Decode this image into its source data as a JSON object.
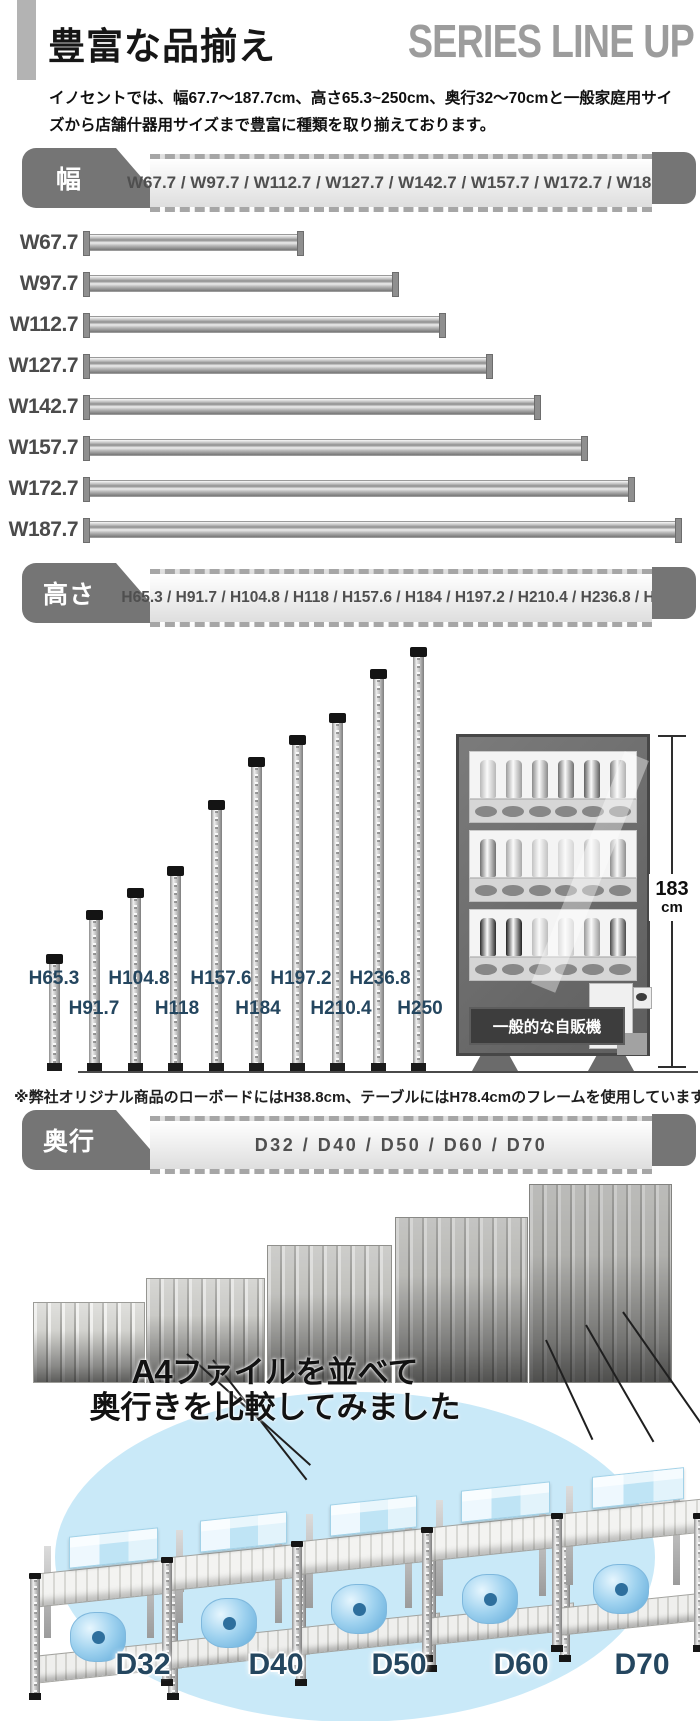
{
  "header": {
    "title": "豊富な品揃え",
    "subtitle": "SERIES LINE UP"
  },
  "intro": {
    "text": "イノセントでは、幅67.7〜187.7cm、高さ65.3~250cm、奥行32〜70cmと一般家庭用サイズから店舗什器用サイズまで豊富に種類を取り揃えております。"
  },
  "width_section": {
    "tab_label": "幅",
    "sizes_text": "W67.7 / W97.7 / W112.7 / W127.7 / W142.7 / W157.7 / W172.7 / W187.7",
    "bars": [
      {
        "label": "W67.7",
        "cm": 67.7
      },
      {
        "label": "W97.7",
        "cm": 97.7
      },
      {
        "label": "W112.7",
        "cm": 112.7
      },
      {
        "label": "W127.7",
        "cm": 127.7
      },
      {
        "label": "W142.7",
        "cm": 142.7
      },
      {
        "label": "W157.7",
        "cm": 157.7
      },
      {
        "label": "W172.7",
        "cm": 172.7
      },
      {
        "label": "W187.7",
        "cm": 187.7
      }
    ]
  },
  "height_section": {
    "tab_label": "高さ",
    "sizes_text": "H65.3 / H91.7 / H104.8 / H118 / H157.6 / H184 / H197.2 / H210.4 / H236.8 / H250",
    "poles": [
      {
        "label": "H65.3",
        "cm": 65.3
      },
      {
        "label": "H91.7",
        "cm": 91.7
      },
      {
        "label": "H104.8",
        "cm": 104.8
      },
      {
        "label": "H118",
        "cm": 118
      },
      {
        "label": "H157.6",
        "cm": 157.6
      },
      {
        "label": "H184",
        "cm": 184
      },
      {
        "label": "H197.2",
        "cm": 197.2
      },
      {
        "label": "H210.4",
        "cm": 210.4
      },
      {
        "label": "H236.8",
        "cm": 236.8
      },
      {
        "label": "H250",
        "cm": 250
      }
    ],
    "vending_machine": {
      "caption": "一般的な自販機",
      "height_value": "183",
      "height_unit": "cm"
    },
    "note": "※弊社オリジナル商品のローボードにはH38.8cm、テーブルにはH78.4cmのフレームを使用しています"
  },
  "depth_section": {
    "tab_label": "奥行",
    "sizes_text": "D32 / D40 / D50 / D60 / D70",
    "depths": [
      {
        "label": "D32",
        "cm": 32
      },
      {
        "label": "D40",
        "cm": 40
      },
      {
        "label": "D50",
        "cm": 50
      },
      {
        "label": "D60",
        "cm": 60
      },
      {
        "label": "D70",
        "cm": 70
      }
    ],
    "compare_title": {
      "bold_prefix": "A4",
      "line1_rest": "ファイルを並べて",
      "line2": "奥行きを比較してみました"
    }
  },
  "colors": {
    "banner_gray": "#757575",
    "label_navy": "#24465f",
    "light_blue": "#c9e9f8",
    "box_blue": "#bfe4f5"
  }
}
